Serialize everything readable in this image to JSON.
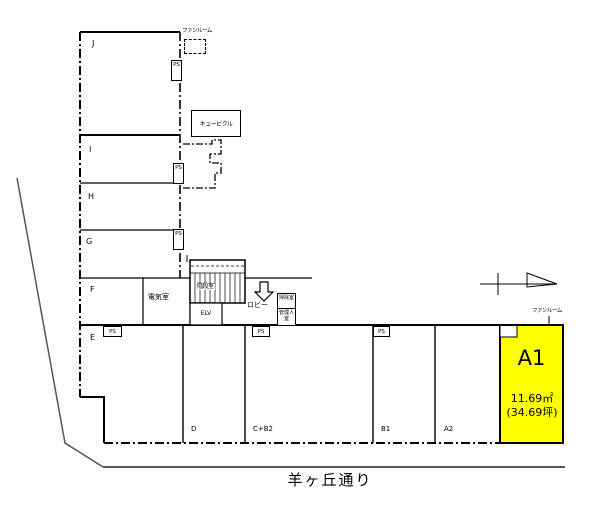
{
  "plan": {
    "street": "羊ヶ丘通り",
    "highlight_unit": {
      "name": "A1",
      "area_sqm": "11.69㎡",
      "area_tsubo": "(34.69坪)",
      "fill_color": "#ffff00"
    },
    "units": {
      "j": "J",
      "i": "I",
      "h": "H",
      "g": "G",
      "f": "F",
      "e": "E",
      "d": "D",
      "cb2": "C+B2",
      "b1": "B1",
      "a2": "A2"
    },
    "facility": {
      "fan_room": "ファンルーム",
      "cubicle": "キュービクル",
      "electric_room": "電気室",
      "stair_room": "階段室",
      "elevator": "ELV",
      "lobby": "ロビー",
      "cleaning_room": "掃除室",
      "manager_room": "管理人室",
      "ps": "PS"
    },
    "line_colors": {
      "wall": "#000000",
      "street_line": "#555555"
    }
  }
}
